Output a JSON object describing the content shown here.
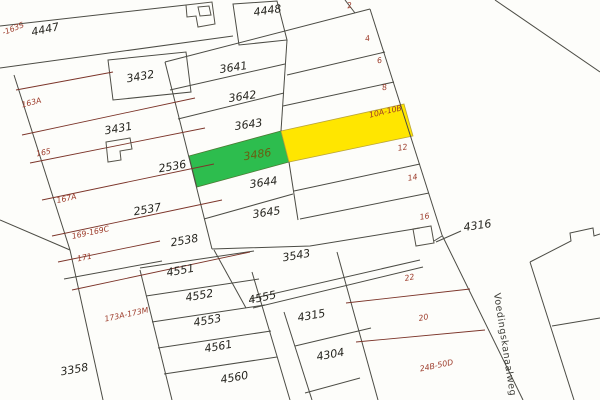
{
  "map": {
    "type": "cadastral-parcel-map",
    "street": {
      "text": "Voedingskanaalweg",
      "x": 502,
      "y": 345,
      "rot": 81
    },
    "highlighted": {
      "green_parcel_number": "3486",
      "yellow_parcel_address": "10A-10B"
    },
    "colors": {
      "highlight_green": "#2dbd4e",
      "highlight_yellow": "#ffe600",
      "boundary": "#4c4c45",
      "boundary_red": "#7c352a",
      "parcel_label": "#26251f",
      "address_label": "#9c3a29",
      "background": "#fdfdfa"
    },
    "parcel_labels": [
      {
        "text": "4447",
        "x": 46,
        "y": 33,
        "rot": -12
      },
      {
        "text": "4448",
        "x": 268,
        "y": 14,
        "rot": -8
      },
      {
        "text": "3432",
        "x": 141,
        "y": 80,
        "rot": -10
      },
      {
        "text": "3431",
        "x": 119,
        "y": 132,
        "rot": -10
      },
      {
        "text": "3641",
        "x": 234,
        "y": 71,
        "rot": -8
      },
      {
        "text": "3642",
        "x": 243,
        "y": 100,
        "rot": -8
      },
      {
        "text": "3643",
        "x": 249,
        "y": 128,
        "rot": -8
      },
      {
        "text": "3486",
        "x": 258,
        "y": 158,
        "rot": -9,
        "variant": "on-green"
      },
      {
        "text": "3644",
        "x": 264,
        "y": 186,
        "rot": -8
      },
      {
        "text": "3645",
        "x": 267,
        "y": 216,
        "rot": -8
      },
      {
        "text": "2536",
        "x": 173,
        "y": 170,
        "rot": -10
      },
      {
        "text": "2537",
        "x": 148,
        "y": 213,
        "rot": -10
      },
      {
        "text": "2538",
        "x": 185,
        "y": 244,
        "rot": -10
      },
      {
        "text": "3543",
        "x": 297,
        "y": 259,
        "rot": -10
      },
      {
        "text": "4555",
        "x": 263,
        "y": 301,
        "rot": -12
      },
      {
        "text": "4315",
        "x": 312,
        "y": 319,
        "rot": -10
      },
      {
        "text": "4304",
        "x": 331,
        "y": 358,
        "rot": -10
      },
      {
        "text": "4316",
        "x": 478,
        "y": 229,
        "rot": -8
      },
      {
        "text": "4551",
        "x": 181,
        "y": 274,
        "rot": -10
      },
      {
        "text": "4552",
        "x": 200,
        "y": 299,
        "rot": -10
      },
      {
        "text": "4553",
        "x": 208,
        "y": 324,
        "rot": -10
      },
      {
        "text": "4561",
        "x": 219,
        "y": 350,
        "rot": -10
      },
      {
        "text": "4560",
        "x": 235,
        "y": 381,
        "rot": -10
      },
      {
        "text": "3358",
        "x": 75,
        "y": 373,
        "rot": -10
      }
    ],
    "address_labels": [
      {
        "text": "-163S",
        "x": 14,
        "y": 31,
        "rot": -22
      },
      {
        "text": "163A",
        "x": 32,
        "y": 105,
        "rot": -14
      },
      {
        "text": "165",
        "x": 44,
        "y": 155,
        "rot": -12
      },
      {
        "text": "167A",
        "x": 67,
        "y": 201,
        "rot": -12
      },
      {
        "text": "169-169C",
        "x": 91,
        "y": 235,
        "rot": -12
      },
      {
        "text": "171",
        "x": 85,
        "y": 260,
        "rot": -12
      },
      {
        "text": "173A-173M",
        "x": 127,
        "y": 317,
        "rot": -12
      },
      {
        "text": "2",
        "x": 350,
        "y": 8,
        "rot": -10
      },
      {
        "text": "4",
        "x": 368,
        "y": 41,
        "rot": -10
      },
      {
        "text": "6",
        "x": 380,
        "y": 63,
        "rot": -10
      },
      {
        "text": "8",
        "x": 385,
        "y": 90,
        "rot": -10
      },
      {
        "text": "10A-10B",
        "x": 386,
        "y": 114,
        "rot": -13
      },
      {
        "text": "12",
        "x": 403,
        "y": 150,
        "rot": -10
      },
      {
        "text": "14",
        "x": 413,
        "y": 180,
        "rot": -10
      },
      {
        "text": "16",
        "x": 425,
        "y": 219,
        "rot": -10
      },
      {
        "text": "22",
        "x": 410,
        "y": 280,
        "rot": -12
      },
      {
        "text": "20",
        "x": 424,
        "y": 320,
        "rot": -12
      },
      {
        "text": "24B-50D",
        "x": 437,
        "y": 368,
        "rot": -12
      }
    ]
  }
}
